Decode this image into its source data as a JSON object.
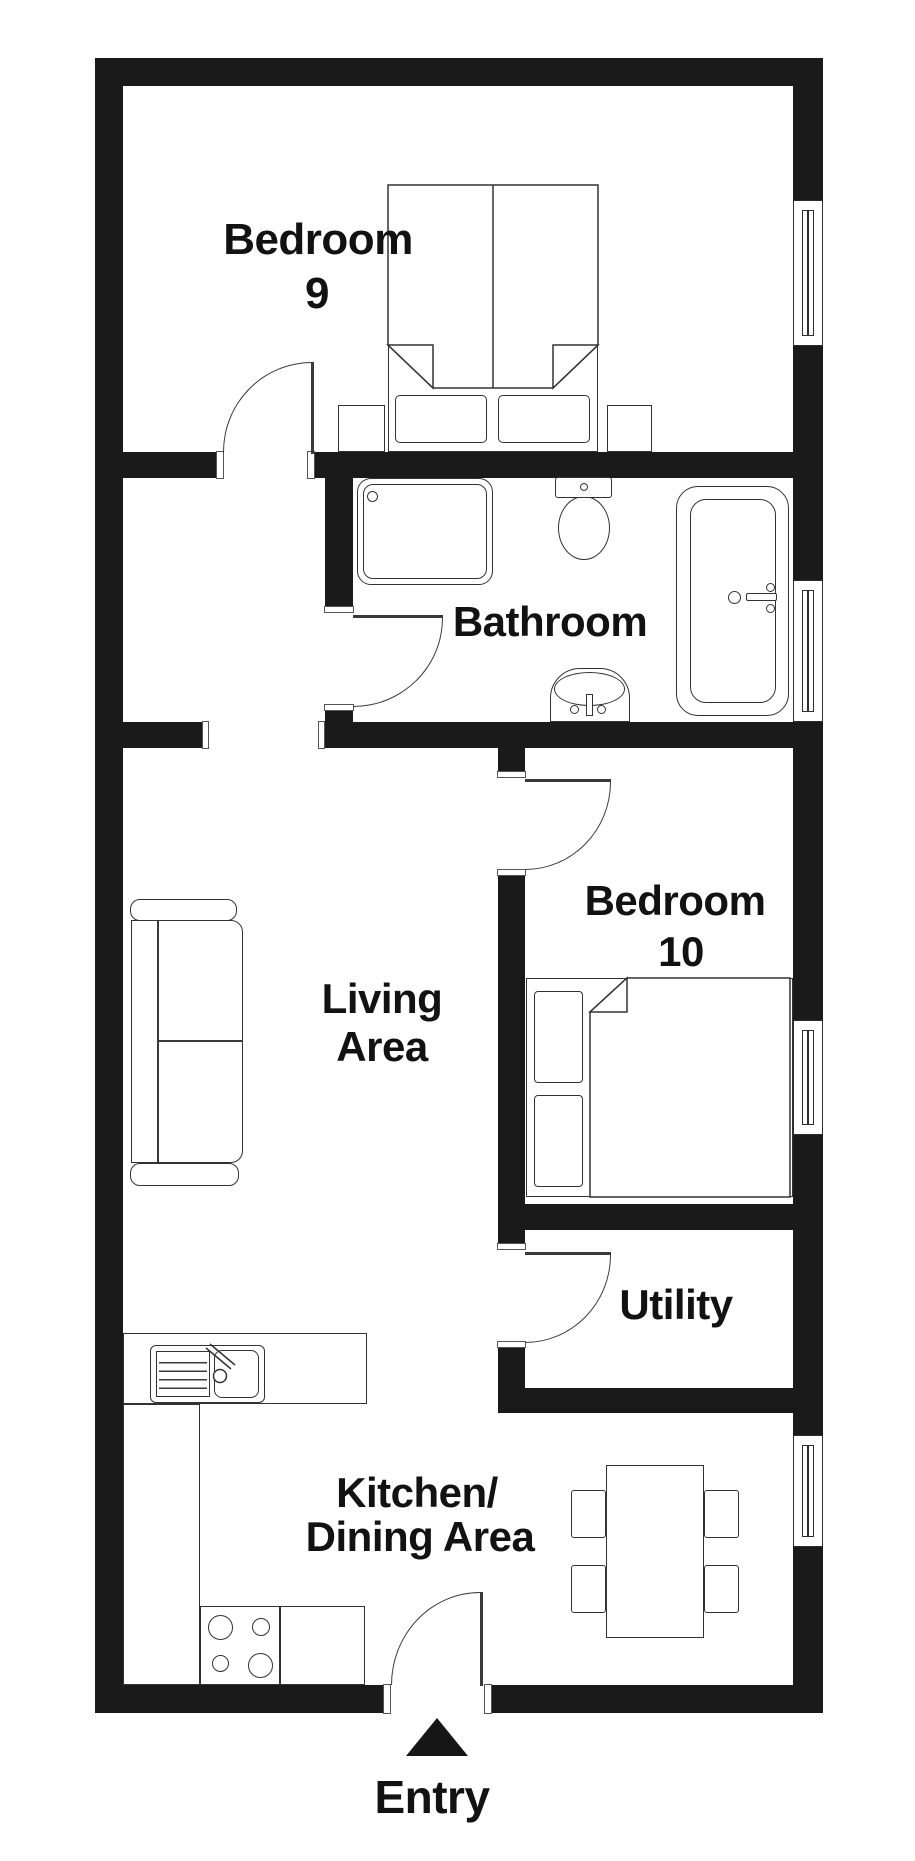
{
  "rooms": {
    "bedroom9": {
      "line1": "Bedroom",
      "line2": "9"
    },
    "bathroom": {
      "line1": "Bathroom"
    },
    "living": {
      "line1": "Living",
      "line2": "Area"
    },
    "bedroom10": {
      "line1": "Bedroom",
      "line2": "10"
    },
    "utility": {
      "line1": "Utility"
    },
    "kitchen": {
      "line1": "Kitchen/",
      "line2": "Dining Area"
    }
  },
  "entry": {
    "label": "Entry"
  },
  "colors": {
    "wall": "#1a1a1a",
    "outline": "#333333",
    "background": "#ffffff",
    "text": "#121212"
  }
}
